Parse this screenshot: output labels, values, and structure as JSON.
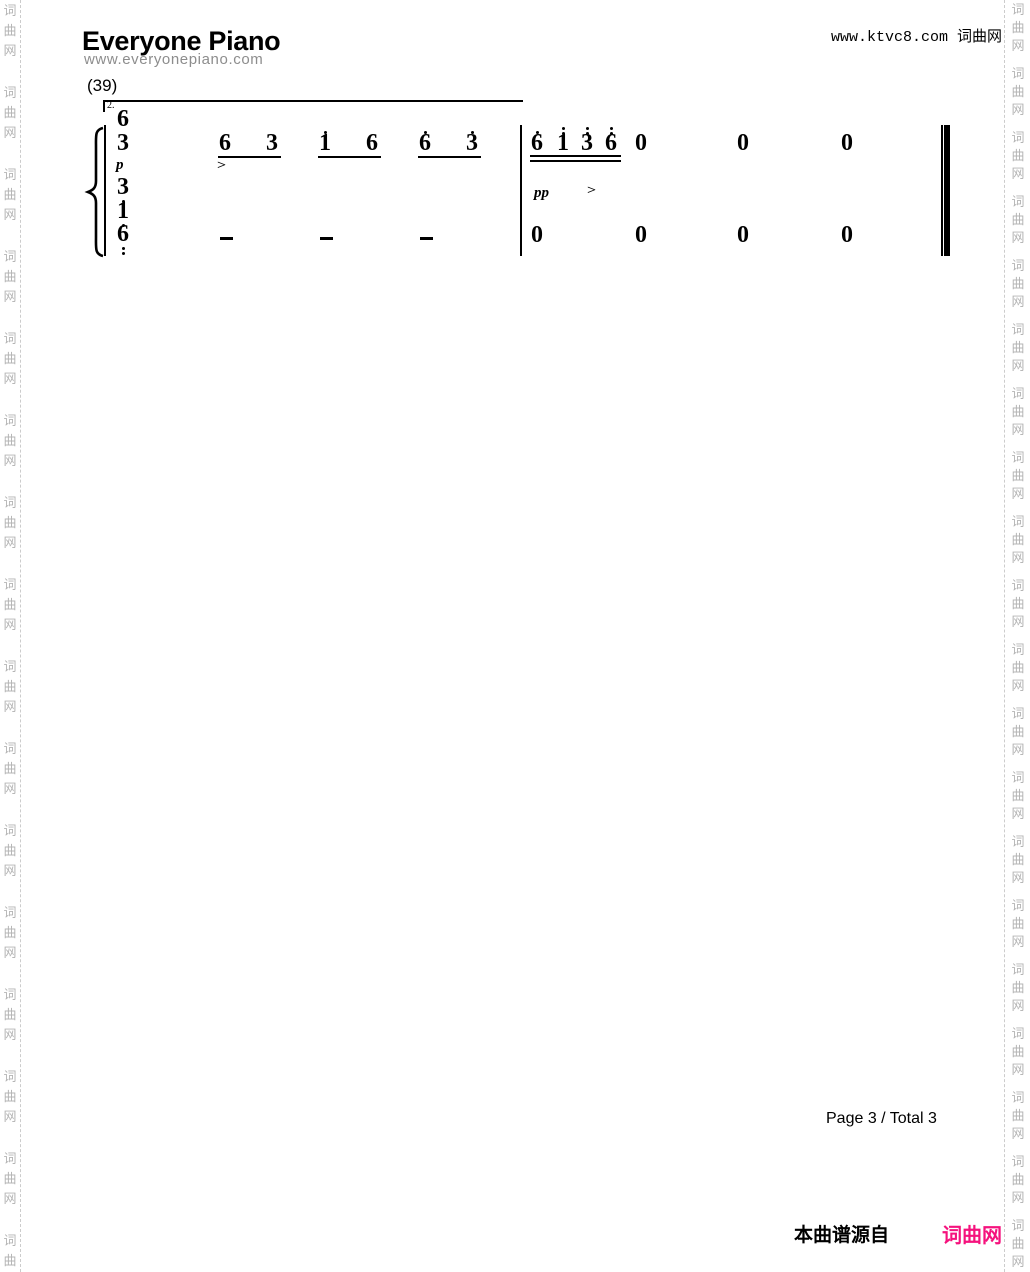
{
  "header": {
    "title": "Everyone Piano",
    "subtitle": "www.everyonepiano.com",
    "top_right": "www.ktvc8.com 词曲网"
  },
  "watermark": {
    "text": "词曲网",
    "char_color": "#b4b4b4",
    "line_color": "#cccccc",
    "left": {
      "x_chars": 2,
      "x_line": 20,
      "start_y": 5,
      "char_step": 20,
      "group_pitch": 82,
      "groups": 16
    },
    "right": {
      "x_chars": 1010,
      "x_line": 1004,
      "start_y": 4,
      "char_step": 18,
      "group_pitch": 64,
      "groups": 20
    }
  },
  "score": {
    "measure_label": "(39)",
    "volta": {
      "label": "2.",
      "x1": 103,
      "x2": 523,
      "y": 100,
      "tick_h": 12
    },
    "system_line": {
      "x": 104,
      "y": 125,
      "h": 131,
      "w": 2
    },
    "barlines": [
      {
        "x": 520,
        "y": 125,
        "h": 131,
        "w": 2
      }
    ],
    "final_barline": {
      "x_thin": 941,
      "w_thin": 2,
      "x_thick": 944,
      "w_thick": 6,
      "y": 125,
      "h": 131
    },
    "notes": [
      {
        "x": 117,
        "y": 112,
        "t": "6"
      },
      {
        "x": 117,
        "y": 136,
        "t": "3"
      },
      {
        "x": 117,
        "y": 180,
        "t": "3",
        "db": 1
      },
      {
        "x": 117,
        "y": 204,
        "t": "1",
        "db": 1
      },
      {
        "x": 117,
        "y": 227,
        "t": "6",
        "db": 2
      },
      {
        "x": 219,
        "y": 136,
        "t": "6"
      },
      {
        "x": 266,
        "y": 136,
        "t": "3"
      },
      {
        "x": 319,
        "y": 136,
        "t": "1",
        "da": 1
      },
      {
        "x": 366,
        "y": 136,
        "t": "6"
      },
      {
        "x": 419,
        "y": 136,
        "t": "6",
        "da": 1
      },
      {
        "x": 466,
        "y": 136,
        "t": "3",
        "da": 1
      },
      {
        "x": 531,
        "y": 136,
        "t": "6",
        "da": 1
      },
      {
        "x": 557,
        "y": 136,
        "t": "1",
        "da": 2
      },
      {
        "x": 581,
        "y": 136,
        "t": "3",
        "da": 2
      },
      {
        "x": 605,
        "y": 136,
        "t": "6",
        "da": 2
      },
      {
        "x": 635,
        "y": 136,
        "t": "0"
      },
      {
        "x": 737,
        "y": 136,
        "t": "0"
      },
      {
        "x": 841,
        "y": 136,
        "t": "0"
      },
      {
        "x": 531,
        "y": 228,
        "t": "0"
      },
      {
        "x": 635,
        "y": 228,
        "t": "0"
      },
      {
        "x": 737,
        "y": 228,
        "t": "0"
      },
      {
        "x": 841,
        "y": 228,
        "t": "0"
      }
    ],
    "beams": [
      {
        "x1": 218,
        "x2": 281,
        "y": 156
      },
      {
        "x1": 318,
        "x2": 381,
        "y": 156
      },
      {
        "x1": 418,
        "x2": 481,
        "y": 156
      },
      {
        "x1": 530,
        "x2": 621,
        "y": 155,
        "double": true
      }
    ],
    "duration_dashes": [
      {
        "x": 220,
        "y": 237
      },
      {
        "x": 320,
        "y": 237
      },
      {
        "x": 420,
        "y": 237
      }
    ],
    "dynamics": [
      {
        "x": 116,
        "y": 158,
        "t": "p"
      },
      {
        "x": 534,
        "y": 186,
        "t": "pp"
      }
    ],
    "accents": [
      {
        "x": 217,
        "y": 160,
        "t": ">"
      },
      {
        "x": 587,
        "y": 185,
        "t": ">"
      }
    ]
  },
  "footer": {
    "page_info": "Page 3 / Total 3",
    "source_prefix": "本曲谱源自",
    "source_site": "词曲网",
    "site_color": "#f5127d"
  }
}
